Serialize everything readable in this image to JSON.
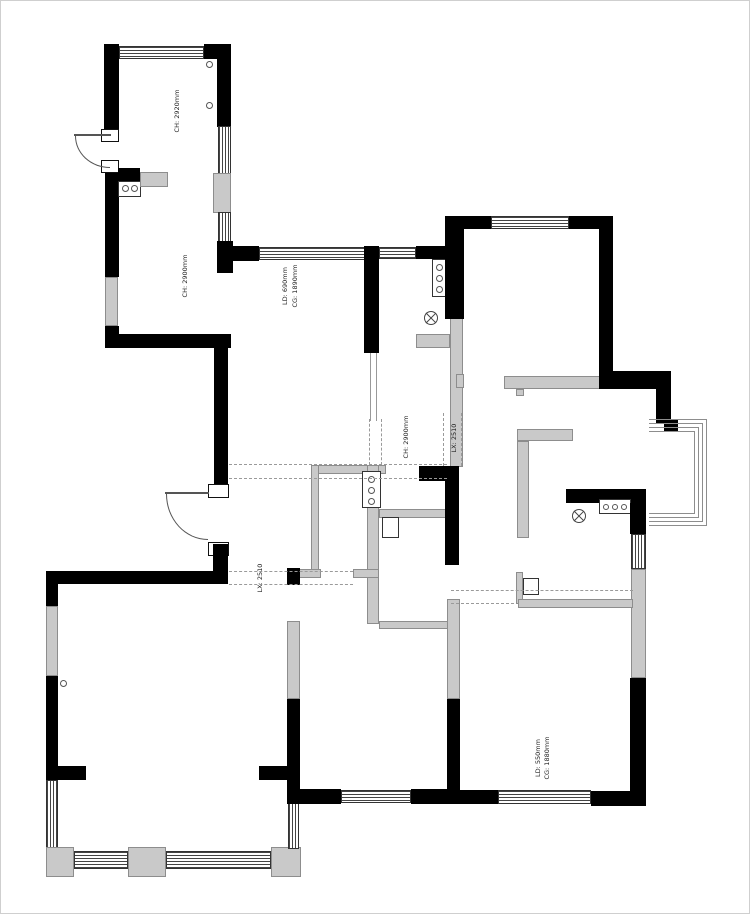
{
  "drawing": {
    "type": "residential-floor-plan",
    "colors": {
      "wall": "#000000",
      "light_element": "#c9c9c9",
      "outline": "#8d8d8d",
      "beam_dash": "#9a9a9a",
      "text": "#222222",
      "background": "#ffffff"
    }
  },
  "labels": {
    "room_topleft_ch": "CH: 2920mm",
    "room_leftwing_ch": "CH: 2900mm",
    "window_top_cg": "CG: 1890mm",
    "window_top_ld": "LD: 690mm",
    "kitchen_ch": "CH: 2900mm",
    "beam_center_lx": "LX: 2510",
    "beam_left_lx": "LX: 2510",
    "room_bottomright_cg": "CG: 1880mm",
    "room_bottomright_ld": "LD: 550mm"
  },
  "symbols": {
    "downlight_count": 3,
    "ceiling_lamp_count": 2,
    "sink_burner_boxes": 4,
    "door_count": 2
  }
}
